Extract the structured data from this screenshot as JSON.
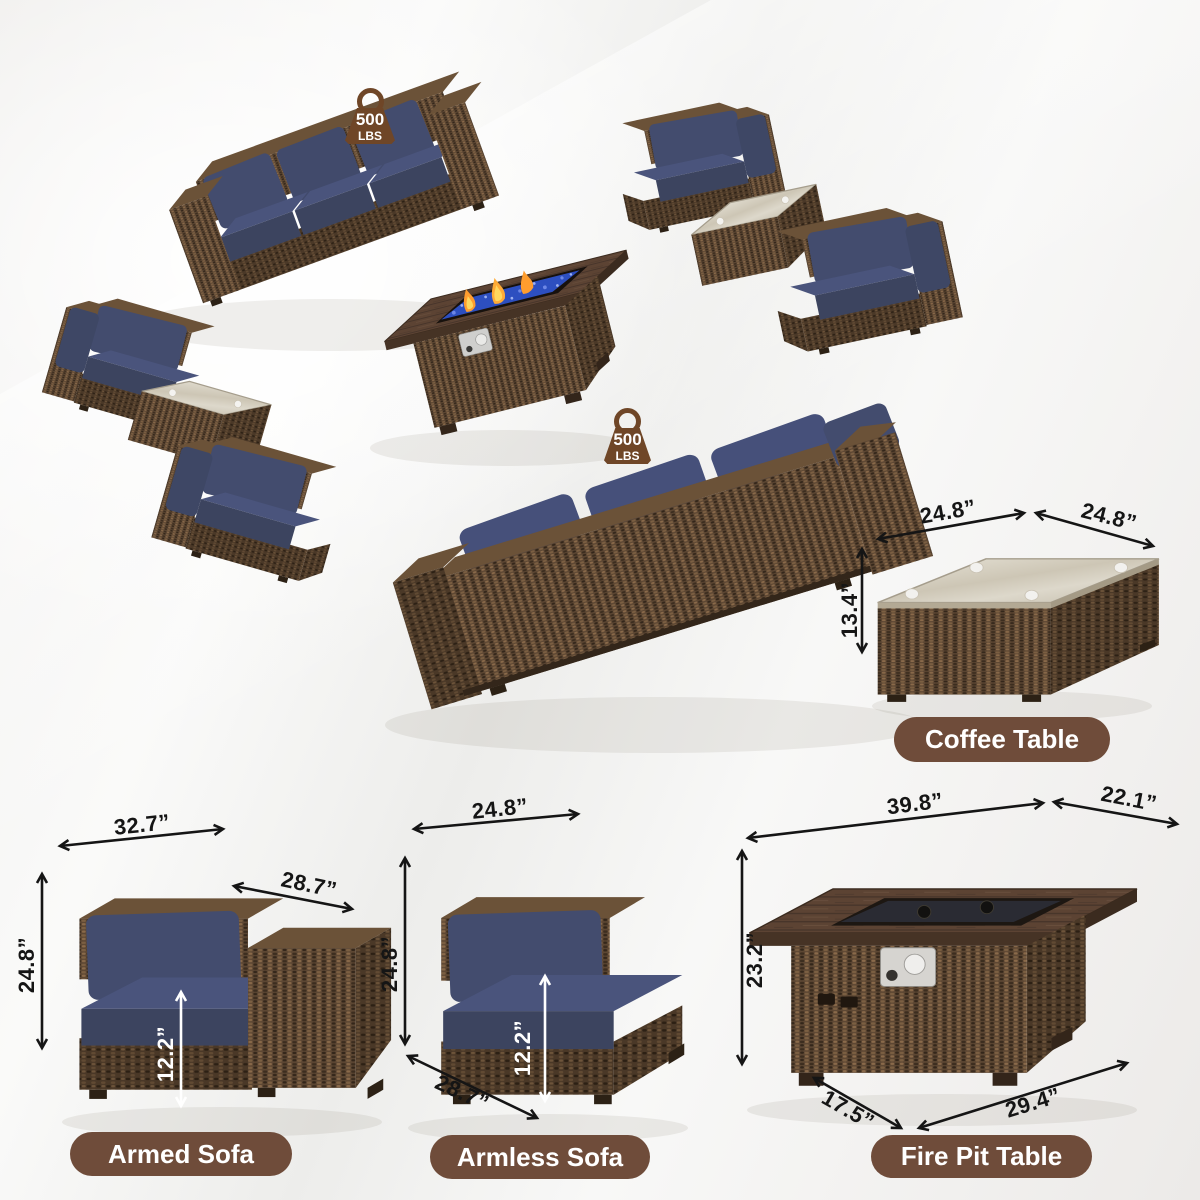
{
  "scene": {
    "weight_badges": [
      {
        "value": "500",
        "unit": "LBS"
      },
      {
        "value": "500",
        "unit": "LBS"
      }
    ]
  },
  "products": {
    "coffee_table": {
      "label": "Coffee Table",
      "dims": {
        "top_width": "24.8”",
        "top_depth": "24.8”",
        "height": "13.4”"
      }
    },
    "armed_sofa": {
      "label": "Armed Sofa",
      "dims": {
        "width": "32.7”",
        "depth": "28.7”",
        "height": "24.8”",
        "seat_height": "12.2”"
      }
    },
    "armless_sofa": {
      "label": "Armless Sofa",
      "dims": {
        "width": "24.8”",
        "height": "24.8”",
        "depth": "28.7”",
        "seat_height": "12.2”"
      }
    },
    "fire_pit_table": {
      "label": "Fire Pit Table",
      "dims": {
        "top_width": "39.8”",
        "top_depth": "22.1”",
        "height": "23.2”",
        "base_depth": "17.5”",
        "base_width": "29.4”"
      }
    }
  },
  "colors": {
    "wicker_brown": "#5d4733",
    "cushion_navy": "#3e4765",
    "label_pill_brown": "#6f4c3a",
    "badge_brown": "#6f4627",
    "dimension_text": "#151515",
    "flame_orange": "#ff9d2e",
    "fire_glass_blue": "#2d4fc0"
  }
}
